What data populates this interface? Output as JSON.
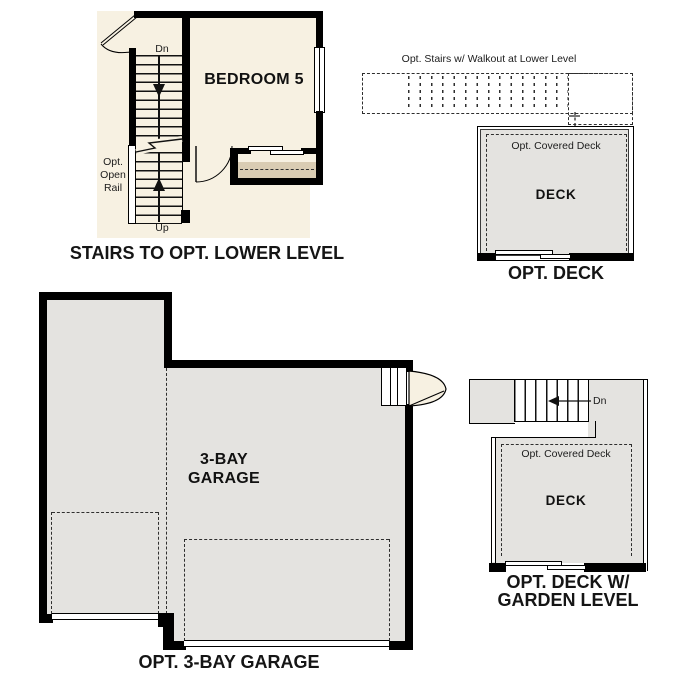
{
  "colors": {
    "cream": "#f7f1e2",
    "tan": "#d9ccb3",
    "gray": "#e4e3e0",
    "wall": "#000000",
    "ink": "#111111"
  },
  "stairs_plan": {
    "caption": "STAIRS TO OPT. LOWER LEVEL",
    "bedroom_label": "BEDROOM 5",
    "dn_label": "Dn",
    "up_label": "Up",
    "rail_line1": "Opt.",
    "rail_line2": "Open",
    "rail_line3": "Rail"
  },
  "opt_deck": {
    "caption": "OPT. DECK",
    "stairs_note": "Opt. Stairs w/ Walkout at Lower Level",
    "covered_label": "Opt. Covered Deck",
    "deck_label": "DECK"
  },
  "garage": {
    "caption": "OPT. 3-BAY GARAGE",
    "room_line1": "3-BAY",
    "room_line2": "GARAGE"
  },
  "garden_deck": {
    "caption_line1": "OPT. DECK W/",
    "caption_line2": "GARDEN LEVEL",
    "dn_label": "Dn",
    "covered_label": "Opt. Covered Deck",
    "deck_label": "DECK"
  }
}
